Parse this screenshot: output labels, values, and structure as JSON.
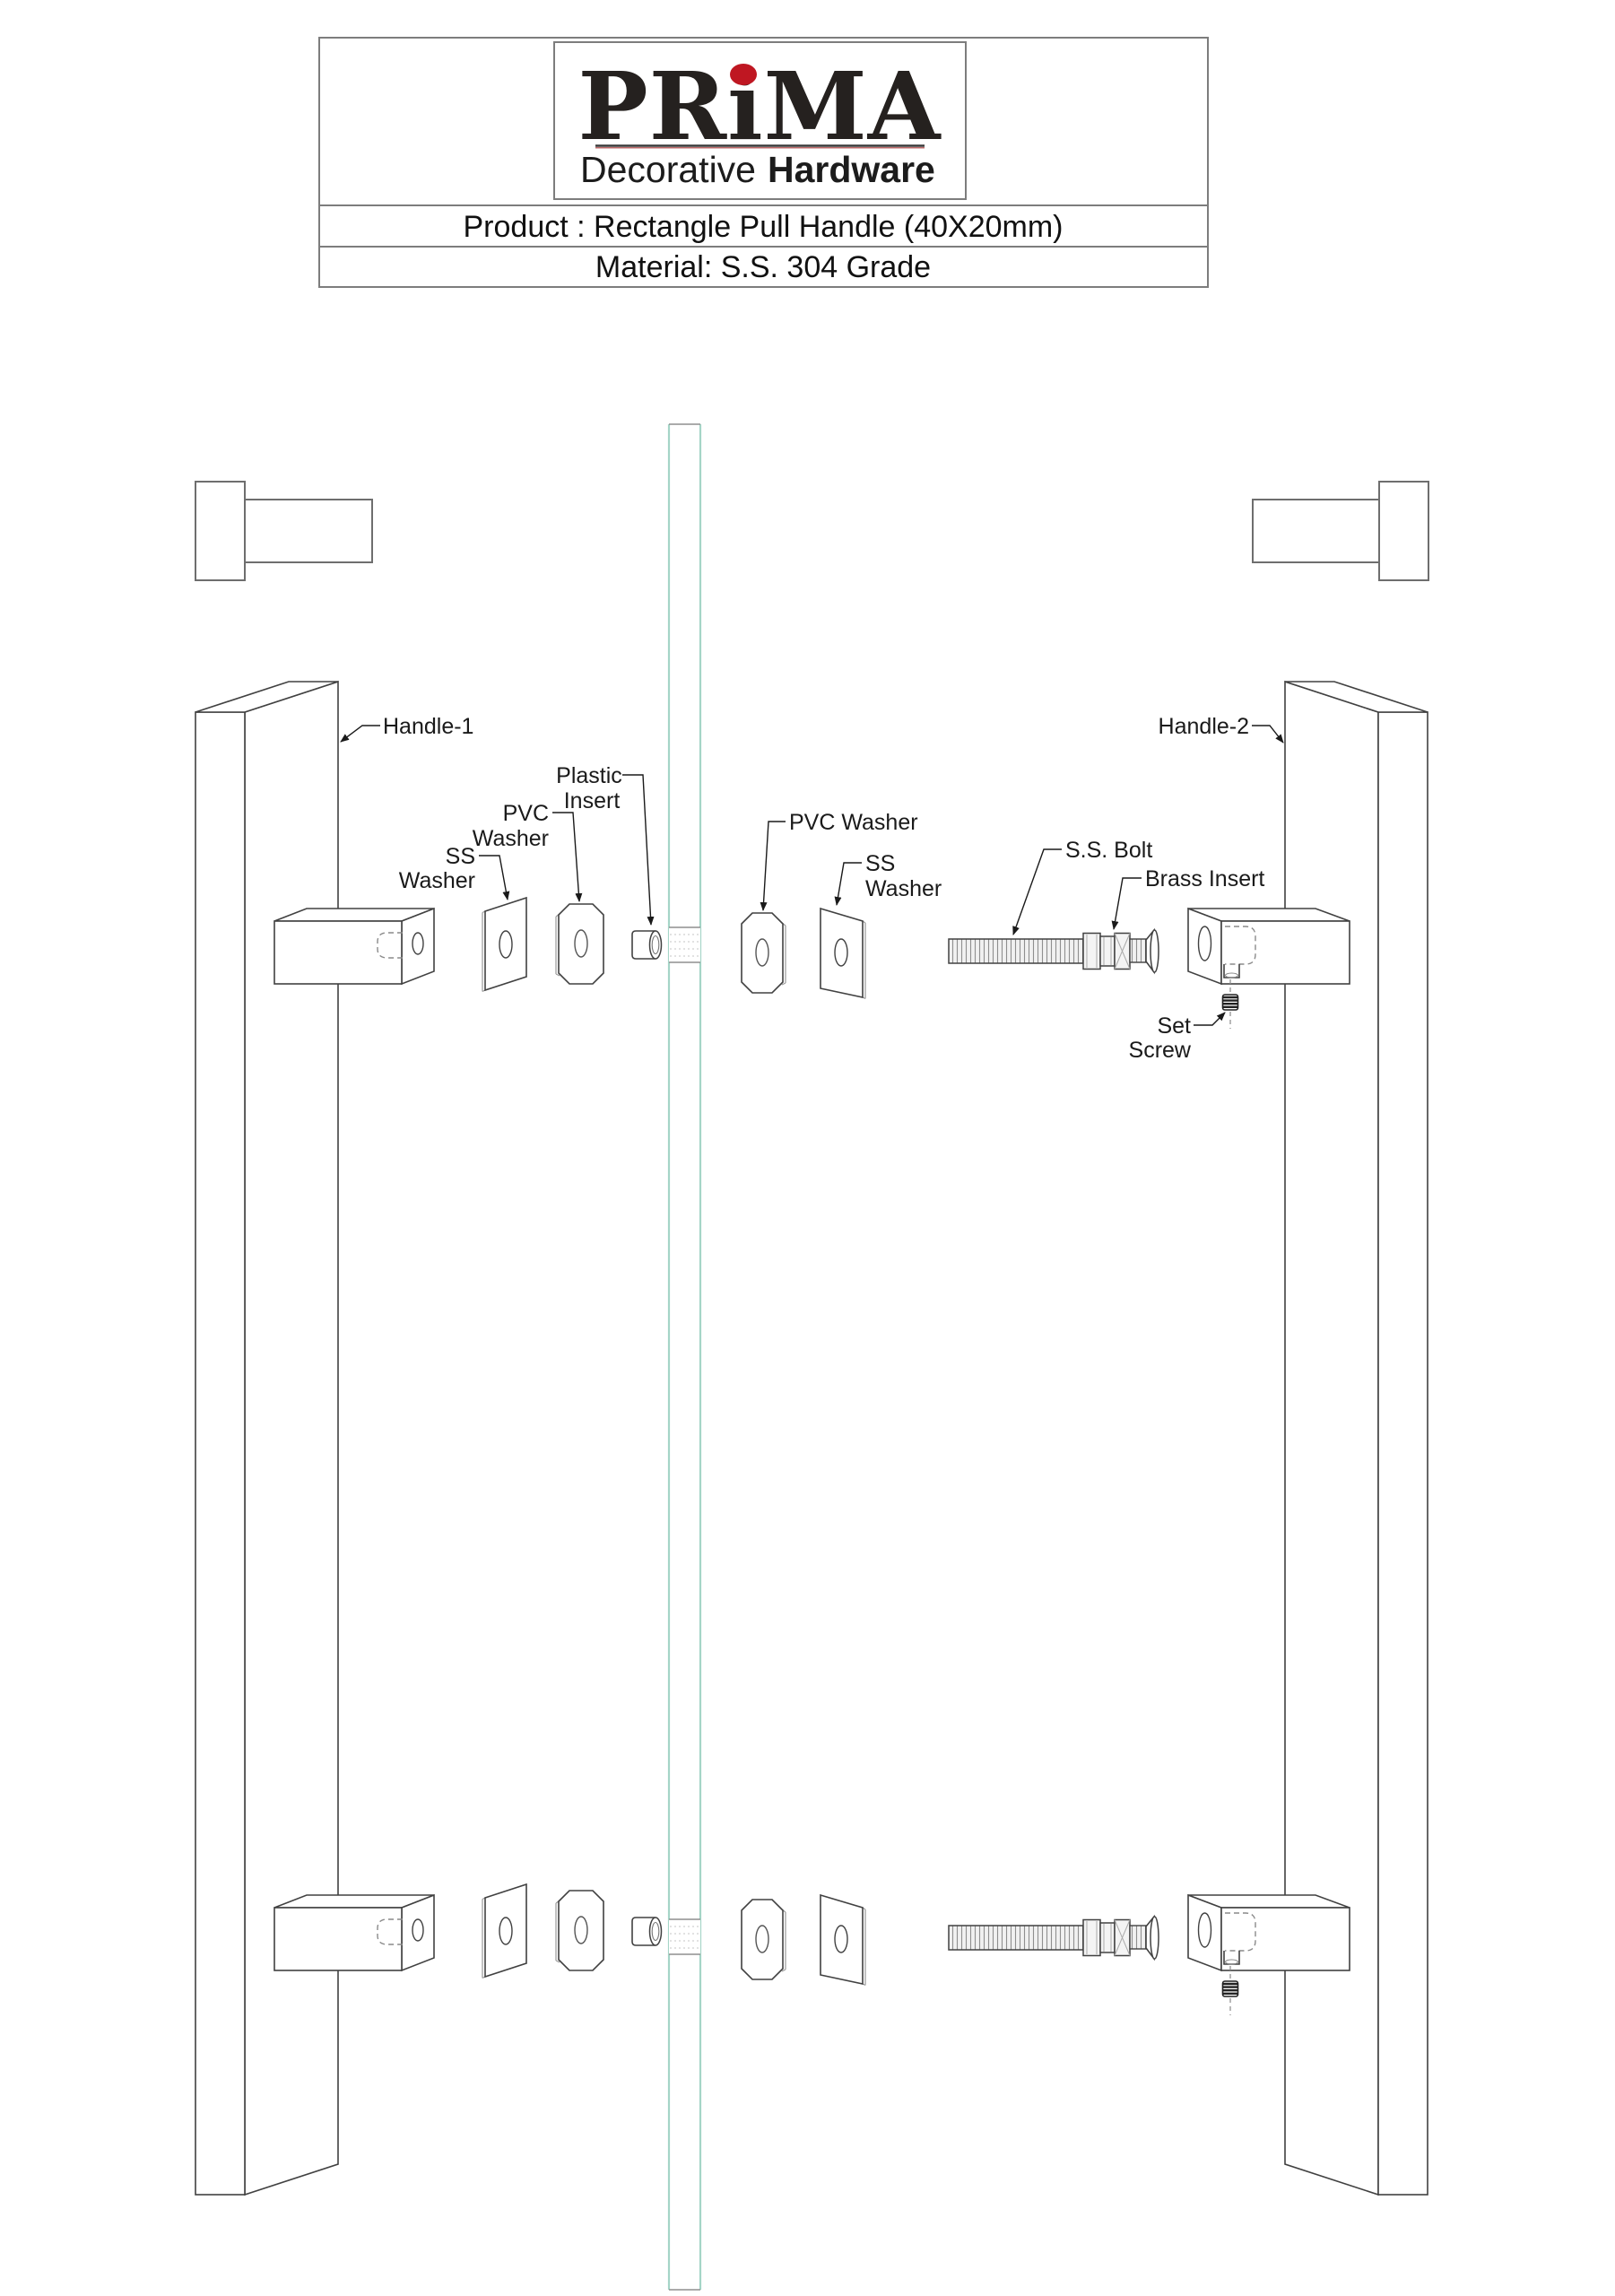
{
  "title_block": {
    "brand": "PRiMA",
    "brand_dot_color": "#bf1722",
    "tagline_regular": "Decorative",
    "tagline_bold": "Hardware",
    "product_line": "Product : Rectangle Pull Handle (40X20mm)",
    "material_line": "Material: S.S. 304 Grade"
  },
  "callouts": {
    "handle_1": "Handle-1",
    "handle_2": "Handle-2",
    "plastic_insert": [
      "Plastic",
      "Insert"
    ],
    "pvc_washer_left": [
      "PVC",
      "Washer"
    ],
    "ss_washer_left": [
      "SS",
      "Washer"
    ],
    "pvc_washer_right": "PVC Washer",
    "ss_washer_right": [
      "SS",
      "Washer"
    ],
    "ss_bolt": "S.S. Bolt",
    "brass_insert": "Brass Insert",
    "set_screw": [
      "Set",
      "Screw"
    ]
  },
  "colors": {
    "drawing_line": "#414141",
    "label_text": "#1a1a1a",
    "glass_edge": "#a5d5c7",
    "glass_hole_hatch": "#c4c4c4",
    "hidden_line": "#8a8a8a",
    "brand_dot": "#bf1722",
    "background": "#ffffff"
  }
}
